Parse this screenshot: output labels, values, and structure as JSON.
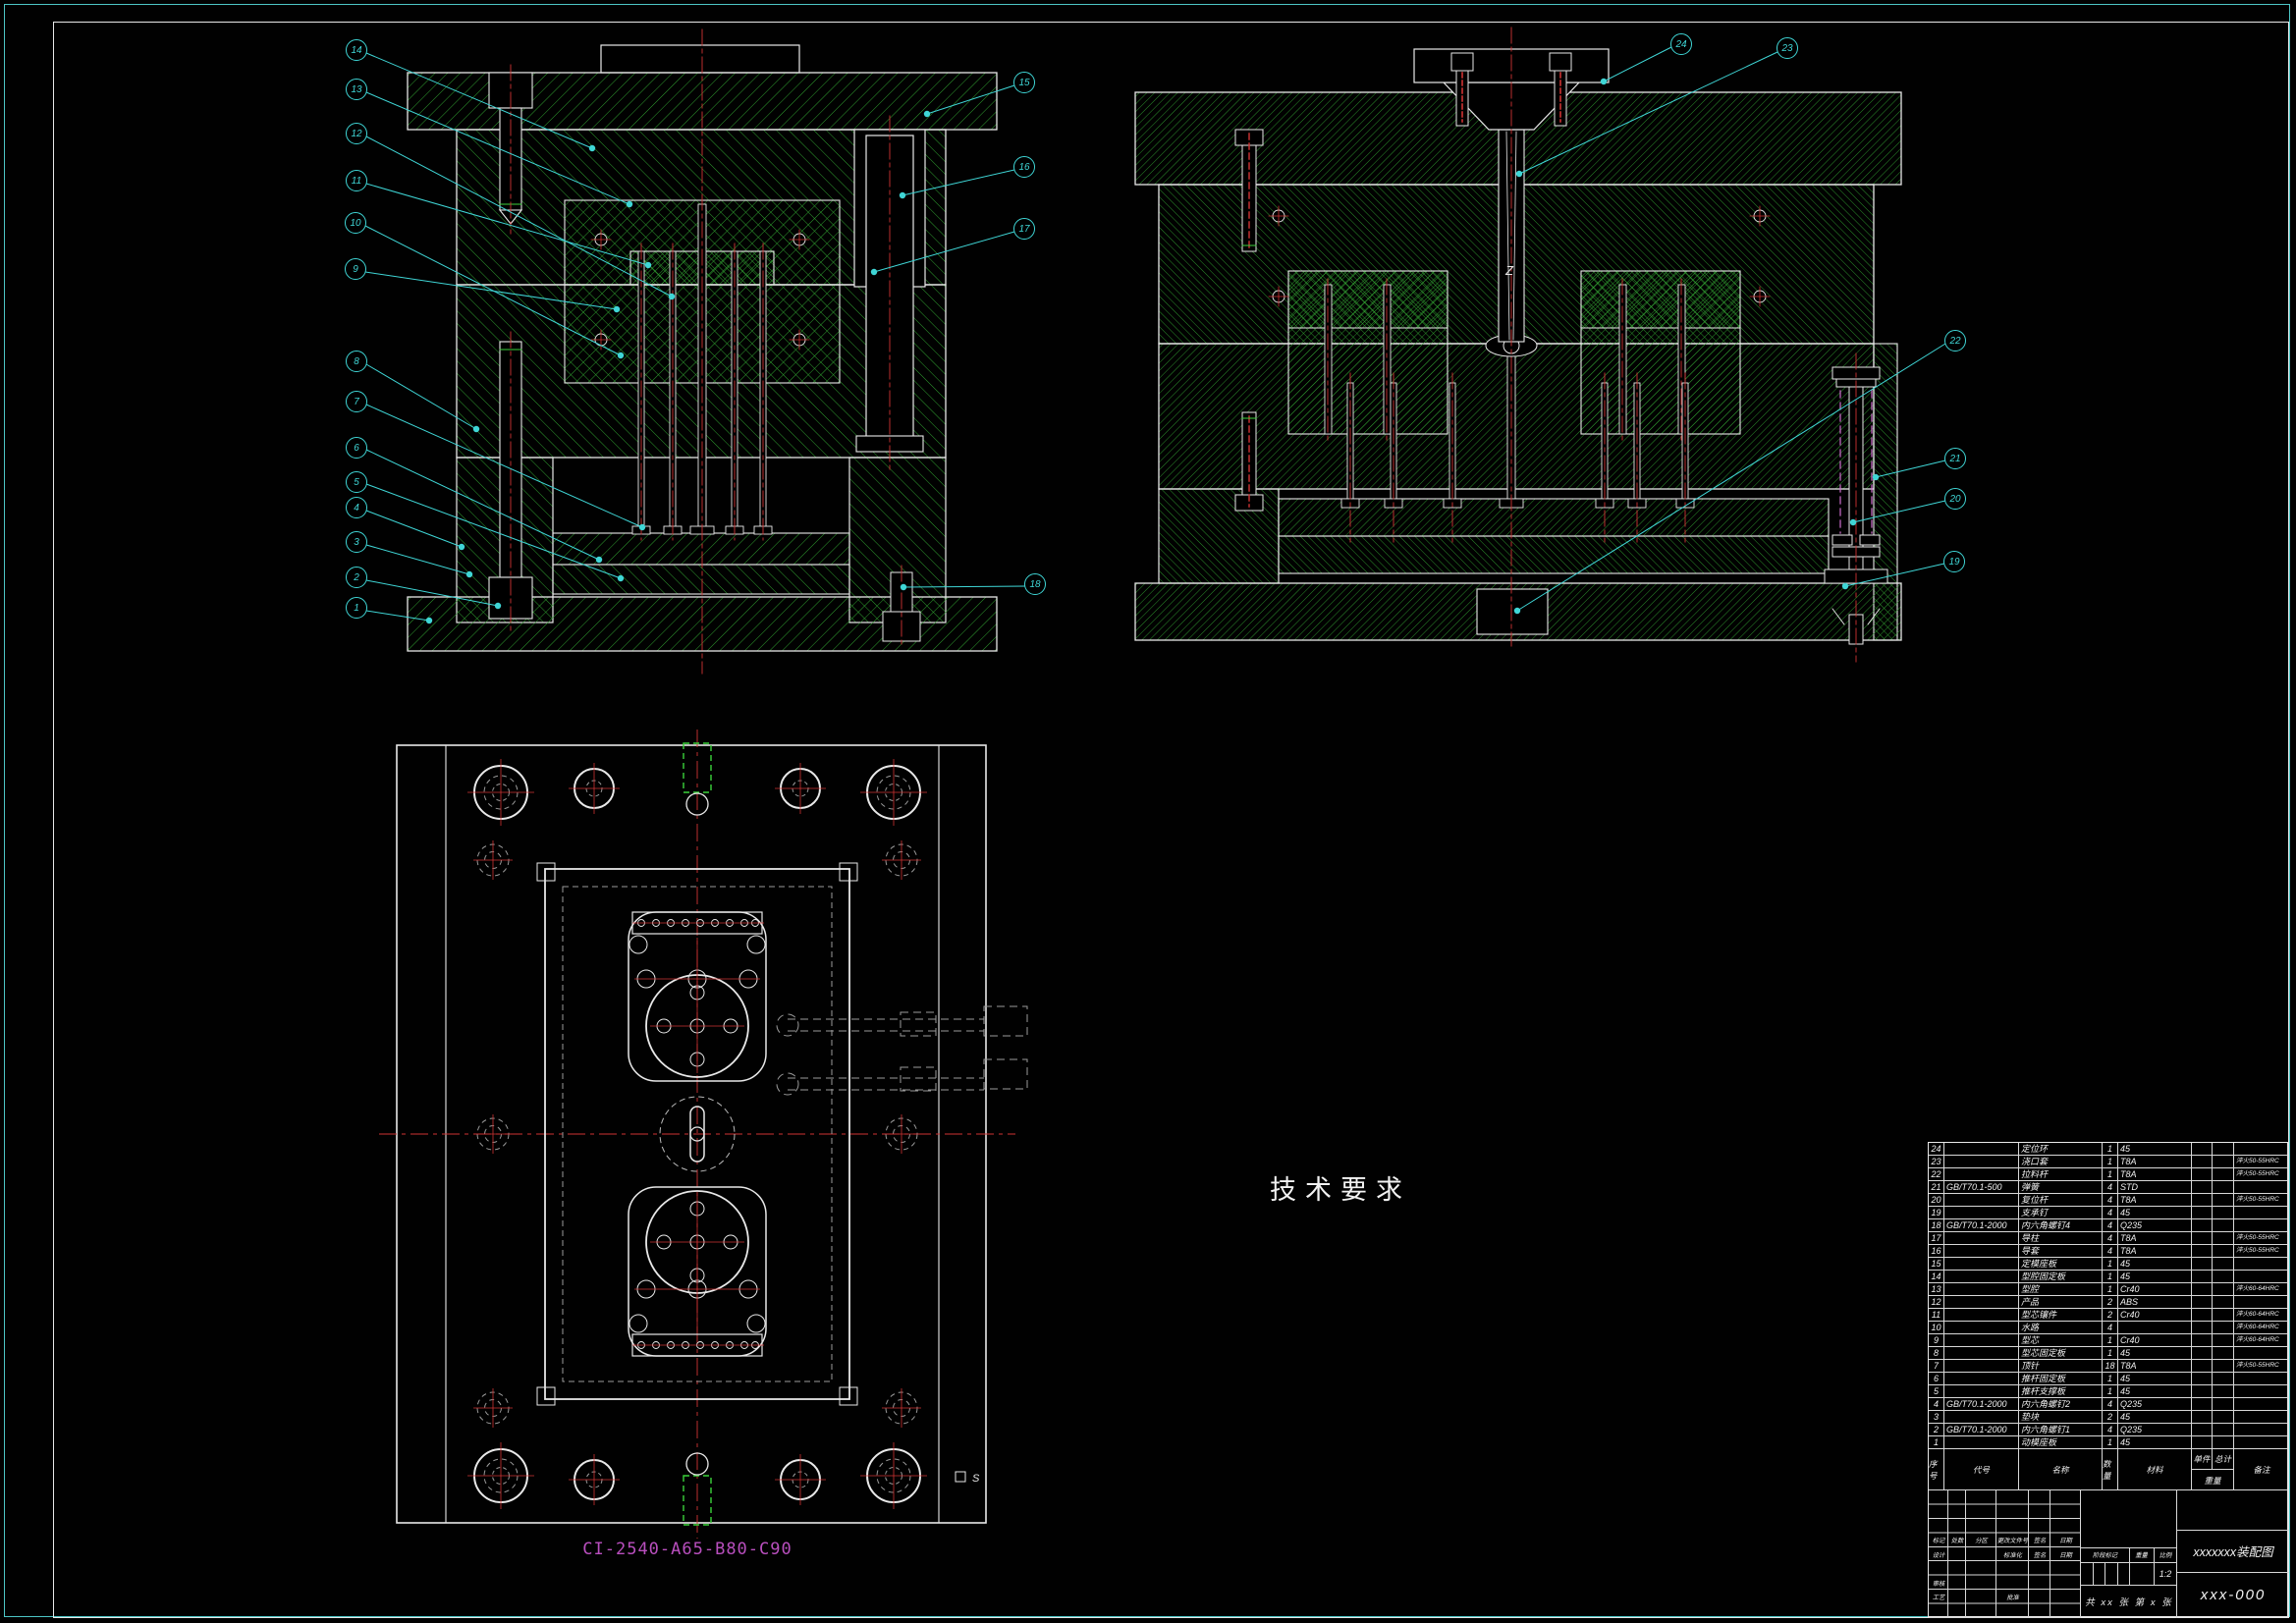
{
  "drawing": {
    "plan_code_label": "CI-2540-A65-B80-C90",
    "annotation_z": "Z",
    "annotation_s": "S"
  },
  "tech_requirements": {
    "title": "技术要求",
    "items": [
      {
        "text": "1.注塑模的外露部分锐角应倒钝，安装面应光滑平整，螺钉、螺钉头部不能高出安装基面，并无明显毛刺、凹陷及变形现象。"
      },
      {
        "text": "2.模具在装配后，动模板沿导柱上、下移动时，应平稳无阻滞现象，导柱与导套的配合精度应符合规定标准要求，且间隙均匀。"
      },
      {
        "text": "3.必须保证模具各零件间的相对位置精度，尤其是当有些尺寸与个零件尺寸有联系时，如分型面的两个平面一已定要保证相互平行。"
      },
      {
        "text": "4.装配后的动模和定模，在合模时必须紧密接触，不得有任何间隙."
      },
      {
        "text": "5.注塑模在合模时定位要准确、可靠，开模出塑件时应畅通无阻."
      }
    ]
  },
  "balloons": [
    {
      "num": "1"
    },
    {
      "num": "2"
    },
    {
      "num": "3"
    },
    {
      "num": "4"
    },
    {
      "num": "5"
    },
    {
      "num": "6"
    },
    {
      "num": "7"
    },
    {
      "num": "8"
    },
    {
      "num": "9"
    },
    {
      "num": "10"
    },
    {
      "num": "11"
    },
    {
      "num": "12"
    },
    {
      "num": "13"
    },
    {
      "num": "14"
    },
    {
      "num": "15"
    },
    {
      "num": "16"
    },
    {
      "num": "17"
    },
    {
      "num": "18"
    },
    {
      "num": "19"
    },
    {
      "num": "20"
    },
    {
      "num": "21"
    },
    {
      "num": "22"
    },
    {
      "num": "23"
    },
    {
      "num": "24"
    }
  ],
  "parts_table": {
    "headers": {
      "seq": "序号",
      "code": "代号",
      "name": "名称",
      "qty": "数量",
      "material": "材料",
      "weight_unit": "单件",
      "weight_total": "总计",
      "weight": "重量",
      "remark": "备注"
    },
    "rows": [
      {
        "seq": "24",
        "code": "",
        "name": "定位环",
        "qty": "1",
        "material": "45",
        "remark": ""
      },
      {
        "seq": "23",
        "code": "",
        "name": "浇口套",
        "qty": "1",
        "material": "T8A",
        "remark": "淬火50-55HRC"
      },
      {
        "seq": "22",
        "code": "",
        "name": "拉料杆",
        "qty": "1",
        "material": "T8A",
        "remark": "淬火50-55HRC"
      },
      {
        "seq": "21",
        "code": "GB/T70.1-500",
        "name": "弹簧",
        "qty": "4",
        "material": "STD",
        "remark": ""
      },
      {
        "seq": "20",
        "code": "",
        "name": "复位杆",
        "qty": "4",
        "material": "T8A",
        "remark": "淬火50-55HRC"
      },
      {
        "seq": "19",
        "code": "",
        "name": "支承钉",
        "qty": "4",
        "material": "45",
        "remark": ""
      },
      {
        "seq": "18",
        "code": "GB/T70.1-2000",
        "name": "内六角螺钉4",
        "qty": "4",
        "material": "Q235",
        "remark": ""
      },
      {
        "seq": "17",
        "code": "",
        "name": "导柱",
        "qty": "4",
        "material": "T8A",
        "remark": "淬火50-55HRC"
      },
      {
        "seq": "16",
        "code": "",
        "name": "导套",
        "qty": "4",
        "material": "T8A",
        "remark": "淬火50-55HRC"
      },
      {
        "seq": "15",
        "code": "",
        "name": "定模座板",
        "qty": "1",
        "material": "45",
        "remark": ""
      },
      {
        "seq": "14",
        "code": "",
        "name": "型腔固定板",
        "qty": "1",
        "material": "45",
        "remark": ""
      },
      {
        "seq": "13",
        "code": "",
        "name": "型腔",
        "qty": "1",
        "material": "Cr40",
        "remark": "淬火60-64HRC"
      },
      {
        "seq": "12",
        "code": "",
        "name": "产品",
        "qty": "2",
        "material": "ABS",
        "remark": ""
      },
      {
        "seq": "11",
        "code": "",
        "name": "型芯镶件",
        "qty": "2",
        "material": "Cr40",
        "remark": "淬火60-64HRC"
      },
      {
        "seq": "10",
        "code": "",
        "name": "水路",
        "qty": "4",
        "material": "",
        "remark": "淬火60-64HRC"
      },
      {
        "seq": "9",
        "code": "",
        "name": "型芯",
        "qty": "1",
        "material": "Cr40",
        "remark": "淬火60-64HRC"
      },
      {
        "seq": "8",
        "code": "",
        "name": "型芯固定板",
        "qty": "1",
        "material": "45",
        "remark": ""
      },
      {
        "seq": "7",
        "code": "",
        "name": "顶针",
        "qty": "18",
        "material": "T8A",
        "remark": "淬火50-55HRC"
      },
      {
        "seq": "6",
        "code": "",
        "name": "推杆固定板",
        "qty": "1",
        "material": "45",
        "remark": ""
      },
      {
        "seq": "5",
        "code": "",
        "name": "推杆支撑板",
        "qty": "1",
        "material": "45",
        "remark": ""
      },
      {
        "seq": "4",
        "code": "GB/T70.1-2000",
        "name": "内六角螺钉2",
        "qty": "4",
        "material": "Q235",
        "remark": ""
      },
      {
        "seq": "3",
        "code": "",
        "name": "垫块",
        "qty": "2",
        "material": "45",
        "remark": ""
      },
      {
        "seq": "2",
        "code": "GB/T70.1-2000",
        "name": "内六角螺钉1",
        "qty": "4",
        "material": "Q235",
        "remark": ""
      },
      {
        "seq": "1",
        "code": "",
        "name": "动模座板",
        "qty": "1",
        "material": "45",
        "remark": ""
      }
    ]
  },
  "title_block": {
    "labels": {
      "mark": "标记",
      "count": "处数",
      "zone": "分区",
      "change_file": "更改文件号",
      "sign": "签名",
      "date": "日期",
      "design": "设计",
      "standardize": "标准化",
      "audit": "审核",
      "process": "工艺",
      "approve": "批准",
      "stage_mark": "阶段标记",
      "weight": "重量",
      "scale": "比例"
    },
    "scale_value": "1:2",
    "sheet_info": "共 xx 张  第 x 张",
    "title": "xxxxxxx装配图",
    "drawing_no": "xxx-000"
  },
  "colors": {
    "hatch_green": "#35ae35",
    "line_white": "#e8e8e8",
    "centerline_red": "#cf3333",
    "leader_cyan": "#3fd6d6",
    "label_magenta": "#b94fbe",
    "border_cyan": "#4dc6c6"
  }
}
